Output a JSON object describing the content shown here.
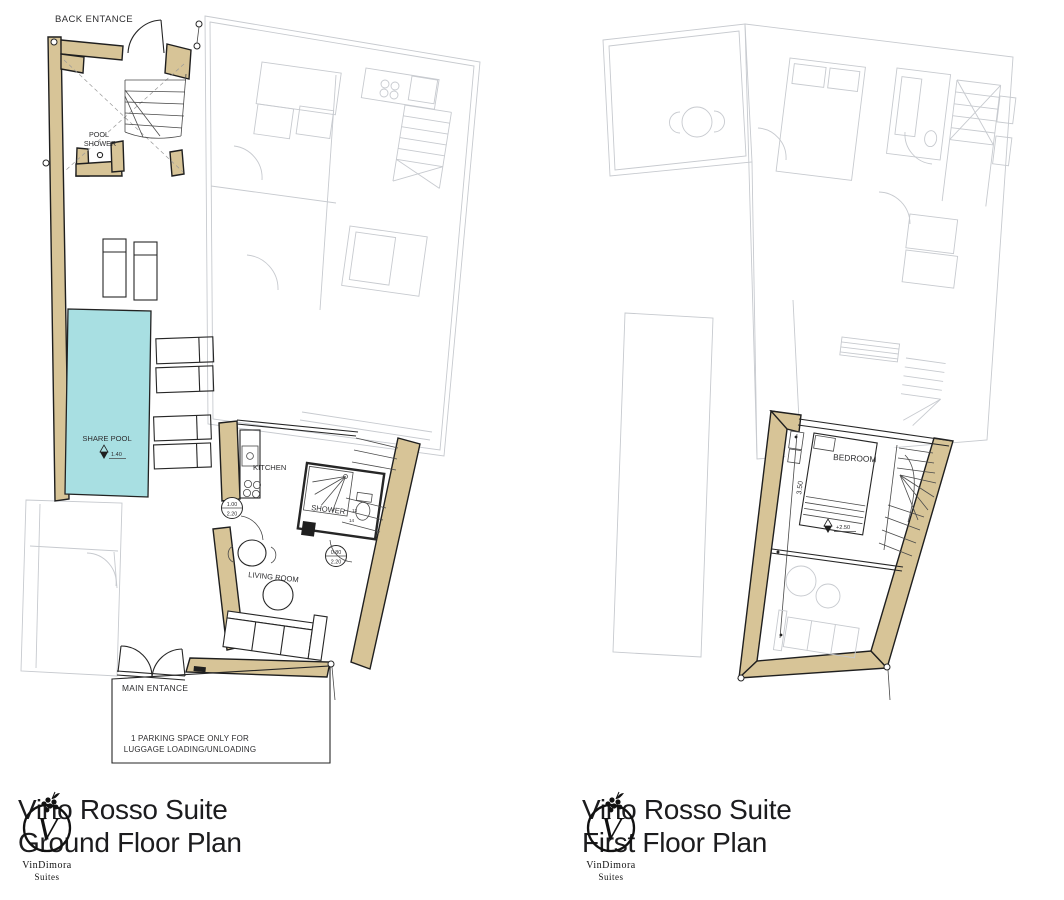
{
  "palette": {
    "wall_fill": "#d7c497",
    "wall_stroke": "#1f1f1f",
    "pool_fill": "#a8dfe2",
    "faded_line": "#c7cacf",
    "text_color": "#2e2e30",
    "title_color": "#1c1c1e"
  },
  "plans": {
    "ground": {
      "title_line1": "Vino Rosso Suite",
      "title_line2": "Ground Floor Plan",
      "labels": {
        "back_entrance": "BACK ENTANCE",
        "pool_shower_1": "POOL",
        "pool_shower_2": "SHOWER",
        "share_pool": "SHARE POOL",
        "pool_depth": "1.40",
        "kitchen": "KITCHEN",
        "shower": "SHOWER",
        "living_room": "LIVING ROOM",
        "main_entrance": "MAIN ENTANCE",
        "parking_1": "1 PARKING SPACE ONLY FOR",
        "parking_2": "LUGGAGE LOADING/UNLOADING",
        "door_a_width": "1.00",
        "door_a_height": "2.20",
        "door_b_width": "0.80",
        "door_b_height": "2.20",
        "stair_step_13": "13",
        "stair_step_14": "14"
      }
    },
    "first": {
      "title_line1": "Vino Rosso Suite",
      "title_line2": "First Floor Plan",
      "labels": {
        "bedroom": "BEDROOM",
        "wall_length": "3.50",
        "floor_level": "+2.50"
      }
    }
  },
  "logo": {
    "initial": "V",
    "brand": "VinDimora",
    "sub": "Suites"
  }
}
